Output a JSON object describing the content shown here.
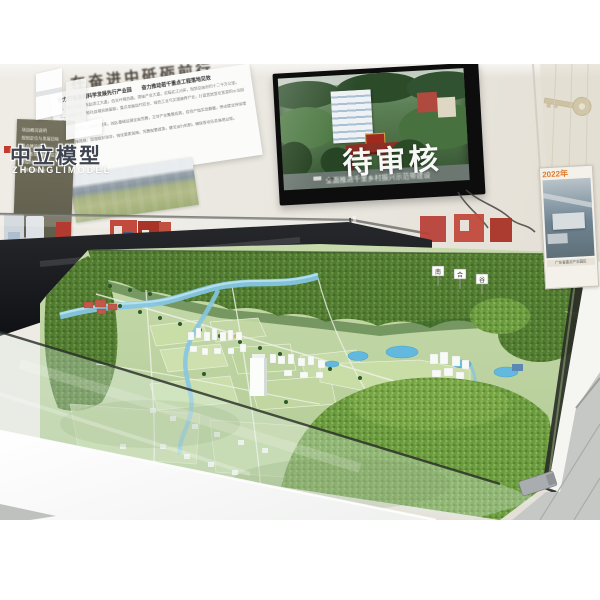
{
  "photo": {
    "watermark": {
      "brand_cn": "中立模型",
      "brand_en": "ZHONGLIMODEL"
    },
    "wall": {
      "headline": "在奋进中砥砺前行",
      "info_board": {
        "title_left": "奋力打造县域科学发展先行产业园",
        "title_right": "奋力推动若干重点工程落地见效",
        "body_lines": [
          "一、规划范围：东起滨江大道，西至环城西路，南接产业大道，北临北江河岸，规划总面积约十二平方公里。",
          "二、功能定位：依托县域资源禀赋，重点发展现代农业、绿色工业与文旅康养产业，打造宜居宜业宜游的示范园区。",
          "三、建设目标：到规划期末，园区基础设施全面完善，主导产业集聚成势，综合产值实现翻番，带动就业持续增长。",
          "四、保障措施：加强组织领导，强化要素保障，完善配套政策，健全运行机制，确保各项任务落地见效。"
        ]
      },
      "side_panel_lines": [
        "项目概况说明",
        "规划定位与发展目标",
        "重点建设内容",
        "产业布局与配套设施",
        "建设时序安排",
        "运营管理机制"
      ],
      "poster": {
        "year_label": "2022年",
        "caption": "广东省重点产业园区"
      }
    },
    "tv_screen": {
      "overlay_status": "待审核",
      "caption": "全面推进千里乡村振兴示范带建设"
    },
    "model_table": {
      "peak_sign_labels": [
        "南",
        "合",
        "谷"
      ]
    },
    "colors": {
      "wall_cream": "#e9e6df",
      "case_black": "#1a1c1e",
      "red_box": "#bc4136",
      "terrain_dark_green": "#527b31",
      "terrain_bright_green": "#7aa647",
      "plain_green": "#c6daab",
      "river_blue": "#85c6e2",
      "pond_blue": "#62b9dd",
      "tv_overlay_white": "#ffffff",
      "poster_year_orange": "#e07b2a",
      "brand_red_chip": "#c23b2e",
      "gold_key": "#b6a269",
      "floor_gray": "#c6c8c6"
    }
  }
}
